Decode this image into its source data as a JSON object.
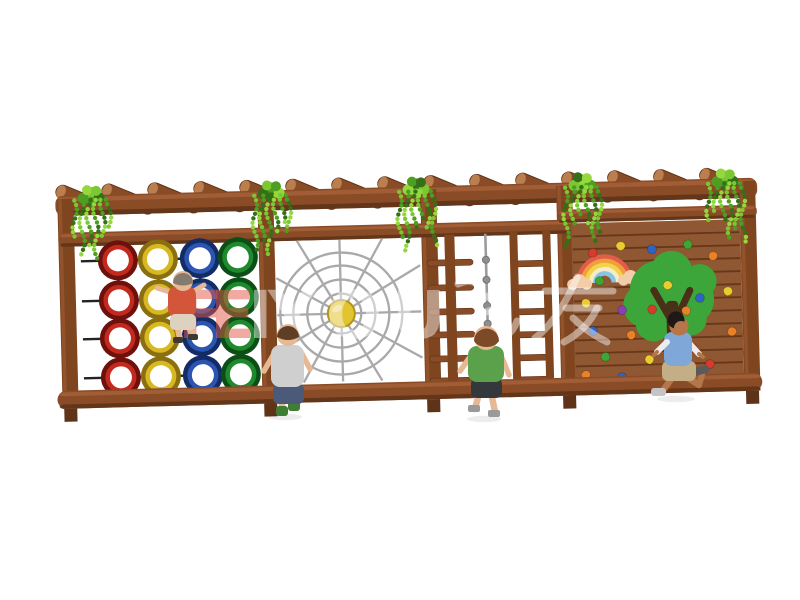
{
  "watermark": {
    "red_color": "#E25847",
    "white_color": "#FFFFFF",
    "red_opacity": 0.5,
    "white_opacity": 0.45,
    "font_size": 66,
    "baseline_y": 338,
    "latin_glyphs": [
      {
        "t": "F",
        "x": 178,
        "c": "red"
      },
      {
        "t": "E",
        "x": 210,
        "c": "red"
      },
      {
        "t": "I",
        "x": 248,
        "c": "white"
      },
      {
        "t": "Y",
        "x": 268,
        "c": "white"
      },
      {
        "t": "O",
        "x": 326,
        "c": "white"
      },
      {
        "t": "U",
        "x": 392,
        "c": "white"
      }
    ],
    "cn_strokes": [
      {
        "d": "M458,284 C470,279 479,281 479,292 L479,324 C479,340 494,343 506,336 C512,332 515,327 517,321"
      },
      {
        "d": "M486,297 L503,290"
      },
      {
        "d": "M486,312 L504,305"
      },
      {
        "d": "M545,291 L613,291"
      },
      {
        "d": "M577,277 C570,294 556,322 535,338"
      },
      {
        "d": "M566,308 L599,308"
      },
      {
        "d": "M597,308 C591,322 579,334 564,342"
      },
      {
        "d": "M573,318 C583,328 595,336 607,342"
      }
    ]
  },
  "palette": {
    "wood_mid": "#8A4C26",
    "wood_dark": "#5E3318",
    "wood_light": "#A5603A",
    "wood_end": "#BB7F4F",
    "post": "#7E451F",
    "grid_line": "#232323",
    "web": "#A9A9A9",
    "sun": "#E2C430",
    "sun_edge": "#B3931A",
    "rope": "#9C9C9C",
    "knot": "#8E8E8E",
    "wall": "#8F5732",
    "wall_line": "#5C3014",
    "trunk": "#4A3018",
    "canopy": "#3CA63A",
    "cloud": "#F2CDAA",
    "shadow": "rgba(0,0,0,0.07)"
  },
  "structure": {
    "rotation_deg": -1.5,
    "pergola": {
      "beam": {
        "x": 58,
        "y": 187,
        "w": 702,
        "h": 20
      },
      "logs": {
        "count": 15,
        "start_x": 85,
        "spacing": 46,
        "cy": 192,
        "half_len": 28,
        "half_th": 7,
        "angle": 24
      }
    },
    "rails": {
      "a": {
        "x": 60,
        "y": 224,
        "w": 516,
        "h": 14
      },
      "b": {
        "x": 559,
        "y": 214,
        "w": 200,
        "h": 13
      }
    },
    "posts": {
      "xs": [
        60,
        260,
        423,
        559,
        742
      ],
      "w": 16,
      "top": 190,
      "bottom": 400,
      "stub_bottom": 413
    },
    "bottom_beam": {
      "x": 55,
      "y": 382,
      "w": 705,
      "h": 18
    },
    "vines": {
      "anchors": [
        94,
        274,
        419,
        585,
        728
      ],
      "top_y": 180,
      "strand_dx": [
        -17,
        -10,
        -3,
        4,
        11,
        17
      ],
      "strand_len": [
        36,
        54,
        46,
        62,
        40,
        30
      ],
      "leaf_colors": [
        "#7CC832",
        "#4E9E22",
        "#356F18",
        "#95D83E"
      ]
    },
    "ring_wall": {
      "panel": {
        "left": 82,
        "right": 258,
        "top": 233,
        "bottom": 382
      },
      "col_x": [
        119,
        159,
        201,
        239
      ],
      "row_y": [
        253,
        293,
        331,
        370
      ],
      "outer_r": 20,
      "face_r": 15.5,
      "hole_r": 11,
      "cols": [
        "red",
        "yellow",
        "blue",
        "green"
      ],
      "colors": {
        "red": {
          "edge": "#6E100C",
          "face": "#C22A1E"
        },
        "yellow": {
          "edge": "#8A6F10",
          "face": "#D7B722"
        },
        "blue": {
          "edge": "#142C66",
          "face": "#2B55B0"
        },
        "green": {
          "edge": "#0C4F16",
          "face": "#1E8A2D"
        }
      }
    },
    "spider_web": {
      "cx": 341,
      "cy": 312,
      "radii": [
        20,
        34,
        48,
        61
      ],
      "spokes": 12,
      "frame": {
        "x1": 277,
        "y1": 238,
        "x2": 421,
        "y2": 380
      },
      "sun_r": 13.5
    },
    "rope_section": {
      "pole": {
        "x": 446,
        "w": 10,
        "top": 236,
        "bottom": 382
      },
      "bars": {
        "x": 428,
        "w": 46,
        "h": 6,
        "ys": [
          261,
          286,
          310,
          333,
          357,
          379
        ]
      },
      "rope": {
        "x": 487,
        "top": 236,
        "bottom": 328,
        "knot_ys": [
          262,
          282,
          308,
          326
        ]
      },
      "ladder": {
        "rails_x": [
          511,
          544
        ],
        "rail_w": 8,
        "top": 234,
        "bottom": 395,
        "rung_ys": [
          264,
          288,
          312,
          335,
          358,
          380
        ]
      }
    },
    "climb_wall": {
      "x": 573,
      "y": 228,
      "w": 169,
      "h": 155,
      "plank_gap": 13,
      "rainbow": {
        "cx": 605,
        "cy": 288,
        "outer_r": 26,
        "band_w": 4.2,
        "colors": [
          "#E25C49",
          "#EFA03C",
          "#F2D44A",
          "#F7ECC9",
          "#86C6E4"
        ],
        "clouds": [
          [
            580,
            286
          ],
          [
            631,
            283
          ]
        ]
      },
      "tree": {
        "canopy": [
          [
            660,
            297,
            30
          ],
          [
            688,
            307,
            26
          ],
          [
            645,
            312,
            22
          ],
          [
            672,
            279,
            21
          ],
          [
            700,
            289,
            17
          ],
          [
            653,
            330,
            18
          ],
          [
            690,
            327,
            16
          ]
        ],
        "trunk": {
          "x": 666,
          "y": 308,
          "w": 12,
          "h": 86
        },
        "branches": [
          [
            672,
            330,
            654,
            297
          ],
          [
            672,
            334,
            690,
            298
          ]
        ]
      },
      "hold_colors": {
        "r": "#D93B2B",
        "o": "#E98126",
        "y": "#E9CC2E",
        "g": "#3FA535",
        "b": "#2F63C4",
        "p": "#8A3FB5"
      },
      "holds": [
        {
          "x": 594,
          "y": 258,
          "c": "r"
        },
        {
          "x": 622,
          "y": 252,
          "c": "y"
        },
        {
          "x": 653,
          "y": 256,
          "c": "b"
        },
        {
          "x": 689,
          "y": 252,
          "c": "g"
        },
        {
          "x": 714,
          "y": 264,
          "c": "o"
        },
        {
          "x": 600,
          "y": 286,
          "c": "g"
        },
        {
          "x": 586,
          "y": 308,
          "c": "y"
        },
        {
          "x": 622,
          "y": 316,
          "c": "p"
        },
        {
          "x": 700,
          "y": 306,
          "c": "b"
        },
        {
          "x": 728,
          "y": 300,
          "c": "y"
        },
        {
          "x": 592,
          "y": 336,
          "c": "b"
        },
        {
          "x": 630,
          "y": 341,
          "c": "o"
        },
        {
          "x": 731,
          "y": 340,
          "c": "o"
        },
        {
          "x": 604,
          "y": 362,
          "c": "g"
        },
        {
          "x": 648,
          "y": 366,
          "c": "y"
        },
        {
          "x": 692,
          "y": 356,
          "c": "r"
        },
        {
          "x": 584,
          "y": 380,
          "c": "o"
        },
        {
          "x": 620,
          "y": 383,
          "c": "b"
        },
        {
          "x": 666,
          "y": 377,
          "c": "p"
        },
        {
          "x": 708,
          "y": 372,
          "c": "r"
        },
        {
          "x": 668,
          "y": 292,
          "c": "y"
        },
        {
          "x": 686,
          "y": 318,
          "c": "o"
        },
        {
          "x": 652,
          "y": 316,
          "c": "r"
        },
        {
          "x": 676,
          "y": 342,
          "c": "b"
        }
      ]
    }
  },
  "children": [
    {
      "skin": "#E6B894",
      "hair": "#857A6E",
      "shirt": "#D4563A",
      "shorts": "#DDD2C0",
      "shoes": "#3E3833"
    },
    {
      "skin": "#E6B894",
      "hair": "#5E3E24",
      "shirt": "#CFCFCF",
      "shorts": "#4A5A78",
      "shoes": "#3F7D35"
    },
    {
      "skin": "#E6B894",
      "hair": "#7C4A26",
      "shirt": "#5BA04A",
      "shorts": "#34373C",
      "shoes": "#9A9A9A"
    },
    {
      "skin": "#B5764A",
      "hair": "#1E1916",
      "shirt": "#7FA8D9",
      "sleeve": "#EDEDED",
      "shorts": "#C3AE85",
      "shoes": "#C4C4C4",
      "shoes_back": "#5A5A5A"
    }
  ]
}
